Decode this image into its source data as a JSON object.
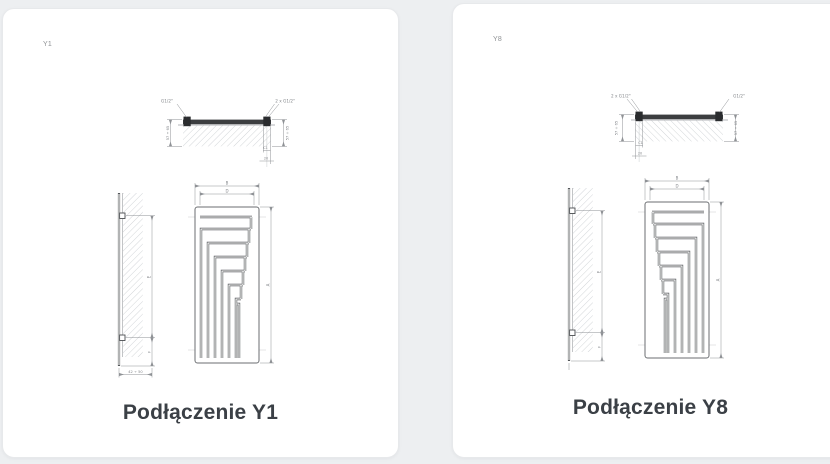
{
  "page": {
    "background": "#edeff1",
    "card_background": "#ffffff"
  },
  "cards": [
    {
      "code": "Y1",
      "caption": "Podłączenie Y1",
      "top_view": {
        "left_port": "G1/2\"",
        "right_port": "2 x G1/2\"",
        "left_depth": "57 ÷ 65",
        "right_depth": "57 ÷ 65",
        "offset": "C1",
        "spacing": "20"
      },
      "front_view": {
        "outer_width": "B",
        "inner_width": "D",
        "height": "A"
      },
      "side_view": {
        "height": "E",
        "bottom_offset": "F",
        "wall_distance": "42 ÷ 50"
      }
    },
    {
      "code": "Y8",
      "caption": "Podłączenie Y8",
      "top_view": {
        "left_port": "2 x G1/2\"",
        "right_port": "G1/2\"",
        "left_depth": "57 ÷ 65",
        "right_depth": "57 ÷ 65",
        "offset": "C1",
        "spacing": "20"
      },
      "front_view": {
        "outer_width": "B",
        "inner_width": "D",
        "height": "A"
      },
      "side_view": {
        "height": "E",
        "bottom_offset": "F"
      }
    }
  ]
}
